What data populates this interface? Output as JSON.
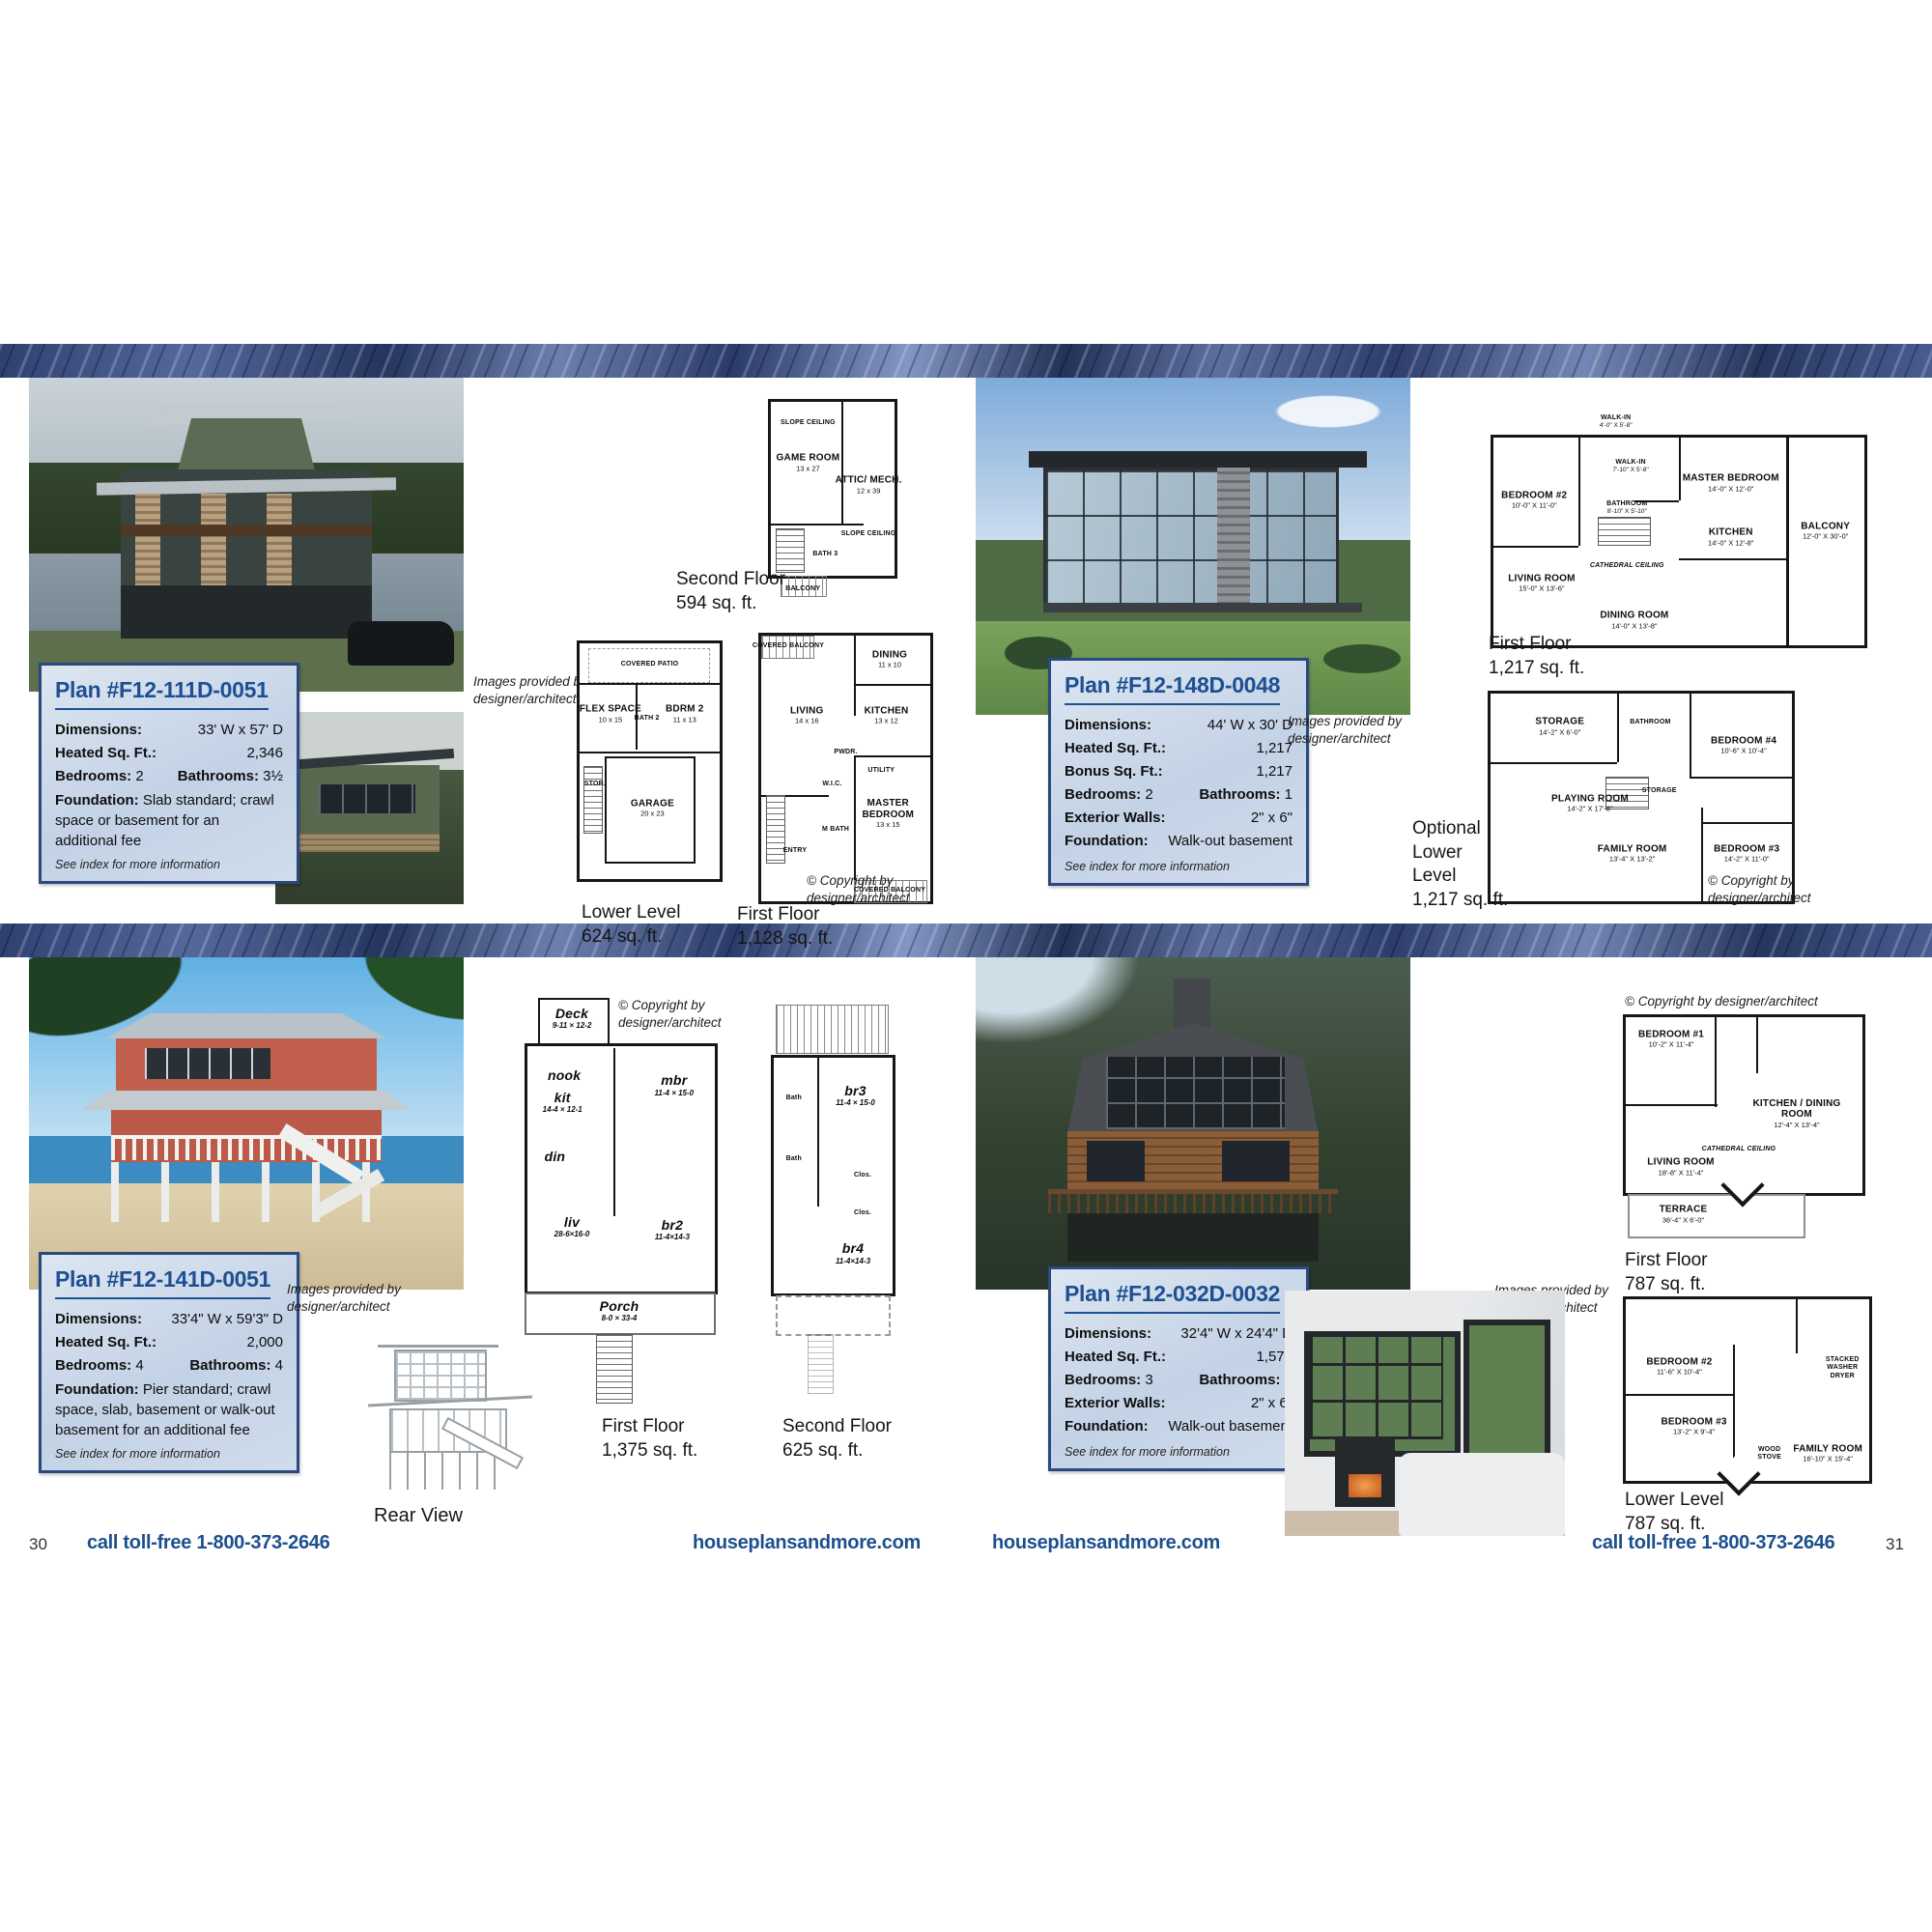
{
  "colors": {
    "accent_navy": "#1d4f92",
    "info_box_bg": "#c9d7e8",
    "info_box_border": "#2a4a7f",
    "footer_text": "#1d4f8f",
    "band_navy": "#2c3d6c"
  },
  "page": {
    "left_number": "30",
    "right_number": "31",
    "phone": "call toll-free 1-800-373-2646",
    "site": "houseplansandmore.com"
  },
  "shared": {
    "credit": "Images provided by designer/architect",
    "copyright_line1": "© Copyright by",
    "copyright_line2": "designer/architect",
    "copyright_inline": "© Copyright by designer/architect"
  },
  "plan1": {
    "title": "Plan #F12-111D-0051",
    "rows": [
      {
        "l": "Dimensions:",
        "v": "33' W x 57' D"
      },
      {
        "l": "Heated Sq. Ft.:",
        "v": "2,346"
      },
      {
        "l": "Bedrooms:",
        "v": "2",
        "l2": "Bathrooms:",
        "v2": "3½"
      },
      {
        "l": "Foundation:",
        "v": "Slab standard; crawl space or basement for an additional fee"
      }
    ],
    "note": "See index for more information",
    "floors": {
      "second": {
        "name": "Second Floor",
        "sqft": "594 sq. ft.",
        "rooms": [
          {
            "n": "GAME ROOM",
            "d": "13 x 27"
          },
          {
            "n": "ATTIC/ MECH.",
            "d": "12 x 39"
          },
          {
            "n": "BATH 3"
          },
          {
            "n": "BALCONY"
          },
          {
            "n": "SLOPE CEILING"
          },
          {
            "n": "SLOPE CEILING"
          }
        ]
      },
      "lower": {
        "name": "Lower Level",
        "sqft": "624 sq. ft.",
        "rooms": [
          {
            "n": "COVERED PATIO"
          },
          {
            "n": "FLEX SPACE",
            "d": "10 x 15"
          },
          {
            "n": "BATH 2"
          },
          {
            "n": "BDRM 2",
            "d": "11 x 13"
          },
          {
            "n": "GARAGE",
            "d": "20 x 23"
          },
          {
            "n": "STOR."
          }
        ]
      },
      "first": {
        "name": "First Floor",
        "sqft": "1,128 sq. ft.",
        "rooms": [
          {
            "n": "COVERED BALCONY"
          },
          {
            "n": "DINING",
            "d": "11 x 10"
          },
          {
            "n": "LIVING",
            "d": "14 x 16"
          },
          {
            "n": "KITCHEN",
            "d": "13 x 12"
          },
          {
            "n": "PWDR."
          },
          {
            "n": "UTILITY"
          },
          {
            "n": "W.I.C."
          },
          {
            "n": "M BATH"
          },
          {
            "n": "MASTER BEDROOM",
            "d": "13 x 15"
          },
          {
            "n": "ENTRY"
          },
          {
            "n": "COVERED BALCONY"
          }
        ]
      }
    }
  },
  "plan2": {
    "title": "Plan #F12-148D-0048",
    "rows": [
      {
        "l": "Dimensions:",
        "v": "44' W x 30' D"
      },
      {
        "l": "Heated Sq. Ft.:",
        "v": "1,217"
      },
      {
        "l": "Bonus Sq. Ft.:",
        "v": "1,217"
      },
      {
        "l": "Bedrooms:",
        "v": "2",
        "l2": "Bathrooms:",
        "v2": "1"
      },
      {
        "l": "Exterior Walls:",
        "v": "2\" x 6\""
      },
      {
        "l": "Foundation:",
        "v": "Walk-out basement"
      }
    ],
    "note": "See index for more information",
    "floors": {
      "first": {
        "name": "First Floor",
        "sqft": "1,217 sq. ft.",
        "rooms": [
          {
            "n": "WALK-IN",
            "d": "4'-0\" X 5'-8\""
          },
          {
            "n": "BEDROOM #2",
            "d": "10'-0\" X 11'-0\""
          },
          {
            "n": "WALK-IN",
            "d": "7'-10\" X 5'-8\""
          },
          {
            "n": "BATHROOM",
            "d": "8'-10\" X 5'-10\""
          },
          {
            "n": "MASTER BEDROOM",
            "d": "14'-0\" X 12'-0\""
          },
          {
            "n": "KITCHEN",
            "d": "14'-0\" X 12'-8\""
          },
          {
            "n": "LIVING ROOM",
            "d": "15'-0\" X 13'-6\""
          },
          {
            "n": "CATHEDRAL CEILING"
          },
          {
            "n": "DINING ROOM",
            "d": "14'-0\" X 13'-8\""
          },
          {
            "n": "BALCONY",
            "d": "12'-0\" X 30'-0\""
          }
        ]
      },
      "lower": {
        "name": "Optional Lower Level",
        "sqft": "1,217 sq. ft.",
        "rooms": [
          {
            "n": "STORAGE",
            "d": "14'-2\" X 6'-0\""
          },
          {
            "n": "BATHROOM"
          },
          {
            "n": "BEDROOM #4",
            "d": "10'-6\" X 10'-4\""
          },
          {
            "n": "PLAYING ROOM",
            "d": "14'-2\" X 17'-8\""
          },
          {
            "n": "FAMILY ROOM",
            "d": "13'-4\" X 13'-2\""
          },
          {
            "n": "BEDROOM #3",
            "d": "14'-2\" X 11'-0\""
          },
          {
            "n": "STORAGE"
          }
        ]
      }
    }
  },
  "plan3": {
    "title": "Plan #F12-141D-0051",
    "rows": [
      {
        "l": "Dimensions:",
        "v": "33'4\" W x 59'3\" D"
      },
      {
        "l": "Heated Sq. Ft.:",
        "v": "2,000"
      },
      {
        "l": "Bedrooms:",
        "v": "4",
        "l2": "Bathrooms:",
        "v2": "4"
      },
      {
        "l": "Foundation:",
        "v": "Pier standard; crawl space, slab, basement or walk-out basement for an additional fee"
      }
    ],
    "note": "See index for more information",
    "rear_view": "Rear View",
    "floors": {
      "first": {
        "name": "First Floor",
        "sqft": "1,375 sq. ft.",
        "rooms": [
          {
            "n": "Deck",
            "d": "9-11 × 12-2"
          },
          {
            "n": "nook"
          },
          {
            "n": "kit",
            "d": "14-4 × 12-1"
          },
          {
            "n": "mbr",
            "d": "11-4 × 15-0"
          },
          {
            "n": "din"
          },
          {
            "n": "liv",
            "d": "28-6×16-0"
          },
          {
            "n": "br2",
            "d": "11-4×14-3"
          },
          {
            "n": "Porch",
            "d": "8-0 × 33-4"
          }
        ]
      },
      "second": {
        "name": "Second Floor",
        "sqft": "625 sq. ft.",
        "rooms": [
          {
            "n": "br3",
            "d": "11-4 × 15-0"
          },
          {
            "n": "br4",
            "d": "11-4×14-3"
          },
          {
            "n": "Bath"
          },
          {
            "n": "Bath"
          },
          {
            "n": "Clos."
          },
          {
            "n": "Clos."
          }
        ]
      }
    }
  },
  "plan4": {
    "title": "Plan #F12-032D-0032",
    "rows": [
      {
        "l": "Dimensions:",
        "v": "32'4\" W x 24'4\" D"
      },
      {
        "l": "Heated Sq. Ft.:",
        "v": "1,574"
      },
      {
        "l": "Bedrooms:",
        "v": "3",
        "l2": "Bathrooms:",
        "v2": "2"
      },
      {
        "l": "Exterior Walls:",
        "v": "2\" x 6\""
      },
      {
        "l": "Foundation:",
        "v": "Walk-out basement"
      }
    ],
    "note": "See index for more information",
    "floors": {
      "first": {
        "name": "First Floor",
        "sqft": "787 sq. ft.",
        "rooms": [
          {
            "n": "BEDROOM #1",
            "d": "10'-2\" X 11'-4\""
          },
          {
            "n": "KITCHEN / DINING ROOM",
            "d": "12'-4\" X 13'-4\""
          },
          {
            "n": "LIVING ROOM",
            "d": "18'-8\" X 11'-4\""
          },
          {
            "n": "CATHEDRAL CEILING"
          },
          {
            "n": "TERRACE",
            "d": "36'-4\" X 6'-0\""
          }
        ]
      },
      "lower": {
        "name": "Lower Level",
        "sqft": "787 sq. ft.",
        "rooms": [
          {
            "n": "BEDROOM #2",
            "d": "11'-6\" X 10'-4\""
          },
          {
            "n": "BEDROOM #3",
            "d": "13'-2\" X 9'-4\""
          },
          {
            "n": "STACKED WASHER DRYER"
          },
          {
            "n": "WOOD STOVE"
          },
          {
            "n": "FAMILY ROOM",
            "d": "16'-10\" X 15'-4\""
          }
        ]
      }
    }
  }
}
